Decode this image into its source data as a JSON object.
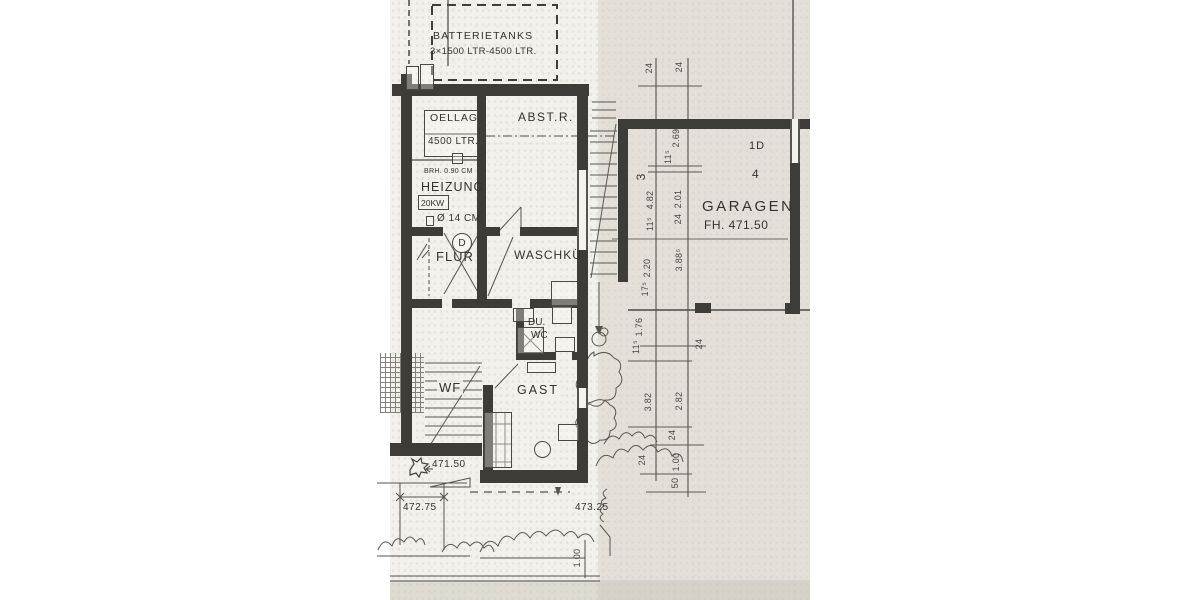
{
  "plan": {
    "tanks": {
      "title": "BATTERIETANKS",
      "subtitle": "3×1500 LTR-4500 LTR."
    },
    "rooms": {
      "oellag": {
        "name": "OELLAG.",
        "capacity": "4500 LTR."
      },
      "heizung": {
        "name": "HEIZUNG",
        "power": "20KW",
        "parapet_note": "BRH. 0.90 CM",
        "pipe_note": "Ø 14 CM"
      },
      "abstellraum": {
        "name": "ABST.R."
      },
      "flur": {
        "name": "FLUR"
      },
      "waschkueche": {
        "name": "WASCHKÜ"
      },
      "dusche_wc": {
        "line1": "DU.",
        "line2": "WC"
      },
      "gast": {
        "name": "GAST"
      },
      "treppe": {
        "name": "WF"
      },
      "garage": {
        "name": "GARAGEN",
        "floor_level": "FH. 471.50",
        "unit": "1D",
        "number": "4",
        "bay": "3"
      }
    },
    "door_label": "D",
    "levels": {
      "terrace": "471.50",
      "left": "472.75",
      "right": "473.25"
    },
    "garden_dim": "1.00",
    "dims_left": [
      "24",
      "4.82",
      "11⁵",
      "2.20",
      "17⁵",
      "1.76",
      "11⁵",
      "3.82",
      "24"
    ],
    "dims_right": [
      "24",
      "2.69",
      "11⁵",
      "2.01",
      "24",
      "3.88⁵",
      "24",
      "2.82",
      "24",
      "1.00",
      "50"
    ]
  }
}
